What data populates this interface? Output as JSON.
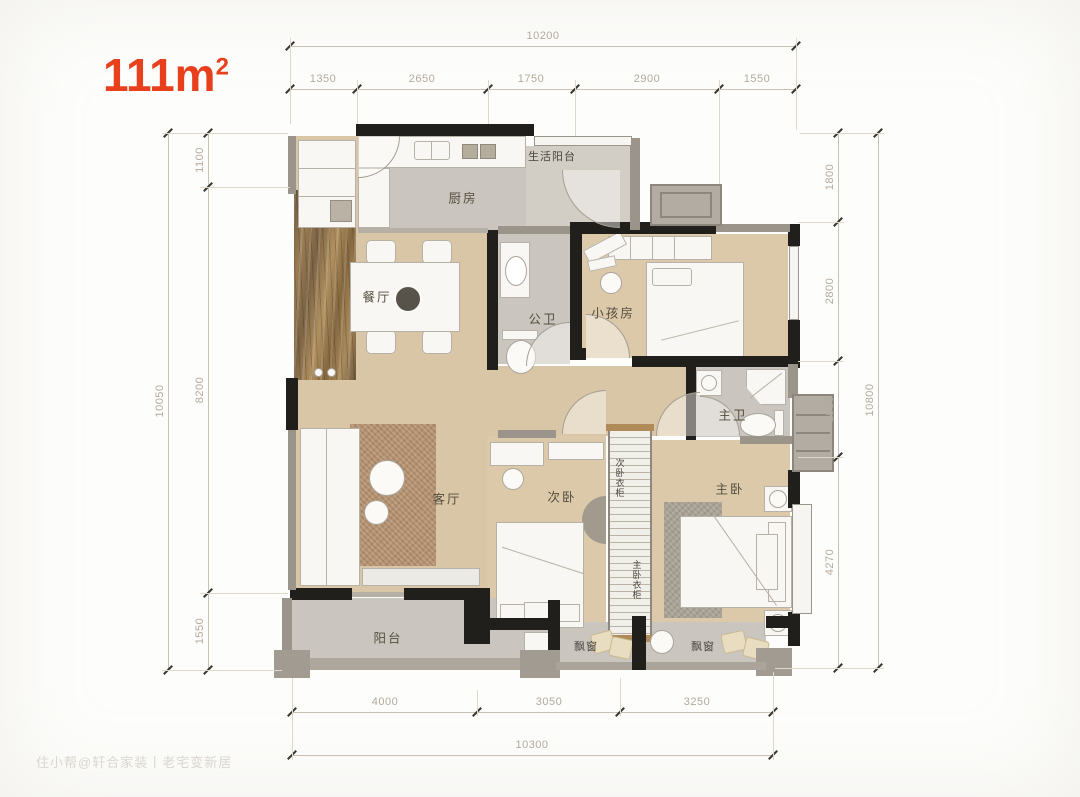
{
  "title": {
    "value": "111m",
    "sup": "2"
  },
  "watermark": {
    "text": "住小帮@轩合家装丨老宅变新居"
  },
  "rooms": {
    "life_balcony": "生活阳台",
    "kitchen": "厨房",
    "dining": "餐厅",
    "guest_bath": "公卫",
    "kids_room": "小孩房",
    "master_bath": "主卫",
    "living": "客厅",
    "second_bedroom": "次卧",
    "second_wardrobe": "次卧衣柜",
    "master_wardrobe": "主卧衣柜",
    "master_bedroom": "主卧",
    "balcony": "阳台",
    "bay_window_1": "飘窗",
    "bay_window_2": "飘窗"
  },
  "dimensions": {
    "top": {
      "total": "10200",
      "segments": [
        "1350",
        "2650",
        "1750",
        "2900",
        "1550"
      ]
    },
    "left": {
      "total": "10050",
      "segments": [
        "1100",
        "8200",
        "1550"
      ]
    },
    "right": {
      "total": "10800",
      "segments": [
        "1800",
        "2800",
        "1930",
        "4270"
      ]
    },
    "bottom": {
      "total": "10300",
      "segments": [
        "4000",
        "3050",
        "3250"
      ]
    }
  },
  "colors": {
    "accent": "#e8401c",
    "wood": "#d9c6a6",
    "wood_dark": "#dcc9a9",
    "tile": "#cac6bf",
    "tile_light": "#d2cec6",
    "wall_black": "#211f1c",
    "wall_gray": "#9b948b",
    "rug_brown": "#b28e6c",
    "rug_gray": "#a8a194",
    "pillow": "#e9ddc1",
    "dim_line": "#c8c1b6",
    "dim_text": "#b3a99d",
    "label": "#554e3e",
    "watermark": "#dad6cf"
  }
}
